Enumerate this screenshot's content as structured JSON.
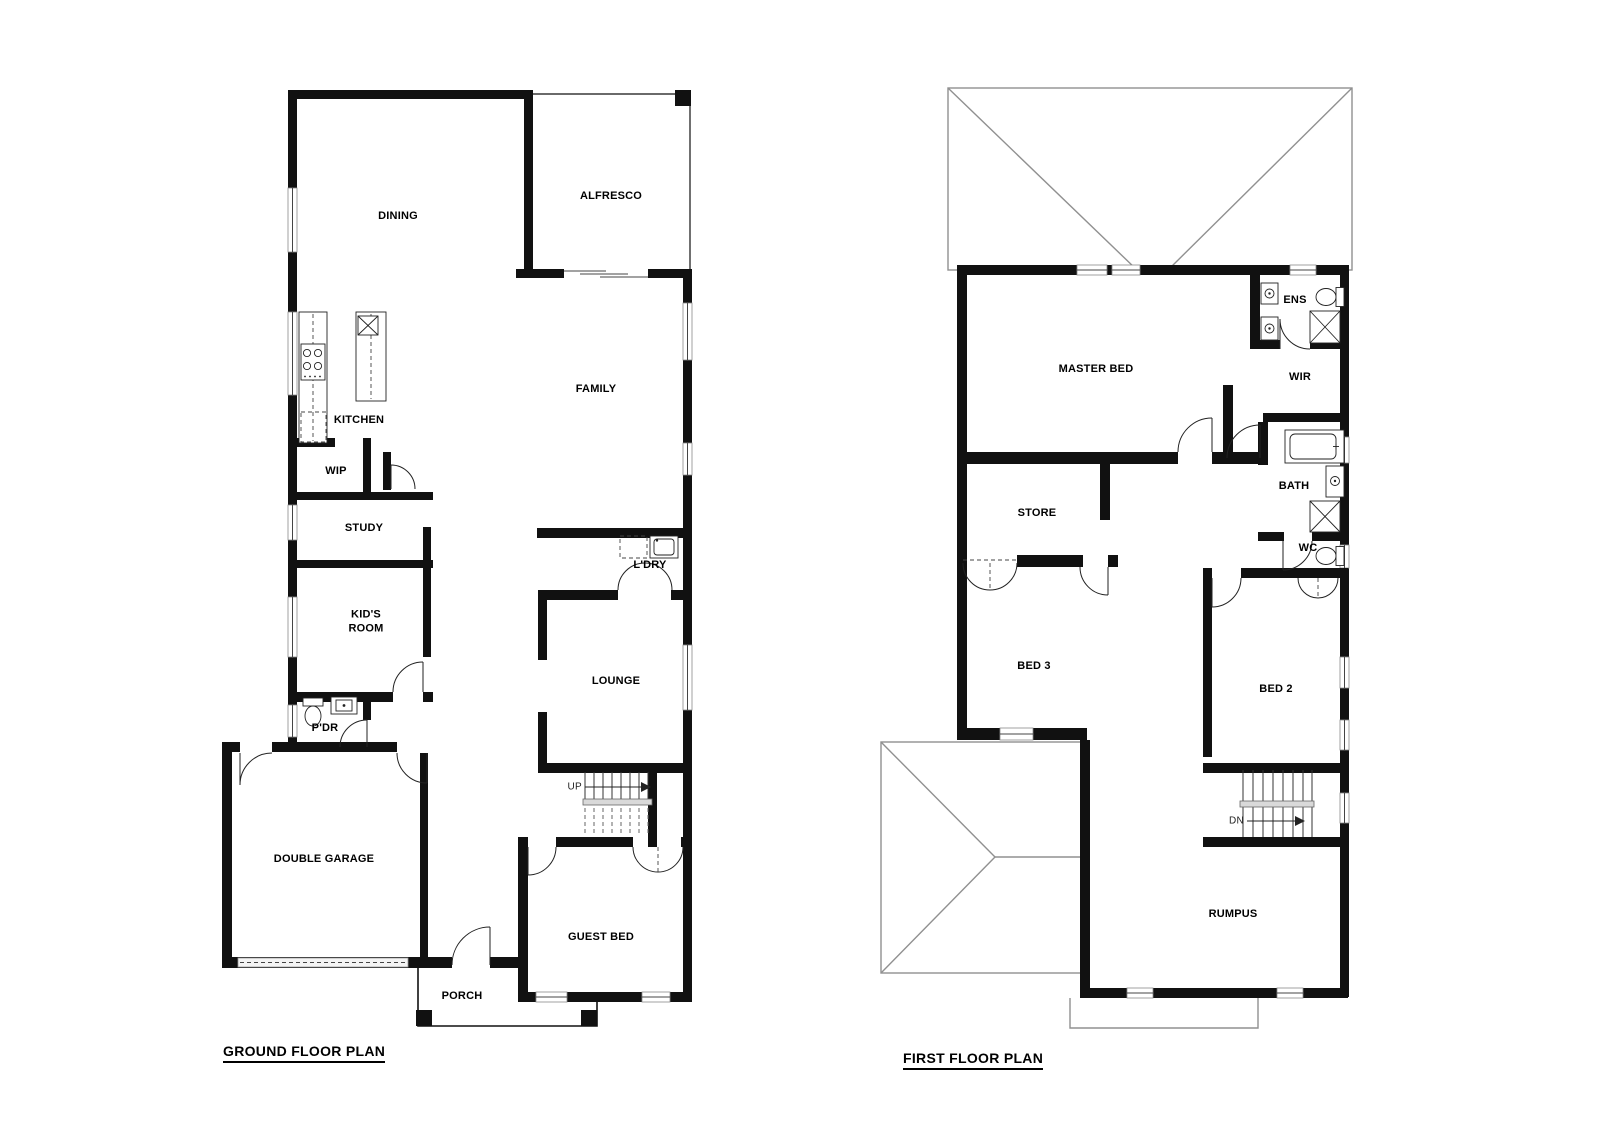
{
  "ground_floor": {
    "title": "GROUND FLOOR PLAN",
    "rooms": {
      "dining": "DINING",
      "alfresco": "ALFRESCO",
      "kitchen": "KITCHEN",
      "wip": "WIP",
      "family": "FAMILY",
      "study": "STUDY",
      "kids_room": "KID'S\nROOM",
      "ldry": "L'DRY",
      "lounge": "LOUNGE",
      "pdr": "P'DR",
      "double_garage": "DOUBLE GARAGE",
      "guest_bed": "GUEST BED",
      "porch": "PORCH"
    },
    "stairs": {
      "direction": "UP"
    }
  },
  "first_floor": {
    "title": "FIRST FLOOR PLAN",
    "rooms": {
      "master_bed": "MASTER BED",
      "ens": "ENS",
      "wir": "WIR",
      "store": "STORE",
      "bath": "BATH",
      "wc": "WC",
      "bed3": "BED 3",
      "bed2": "BED 2",
      "rumpus": "RUMPUS"
    },
    "stairs": {
      "direction": "DN"
    }
  },
  "colors": {
    "wall": "#111111",
    "roof_line": "#909090",
    "window_line": "#444444",
    "background": "#ffffff",
    "text": "#000000"
  }
}
